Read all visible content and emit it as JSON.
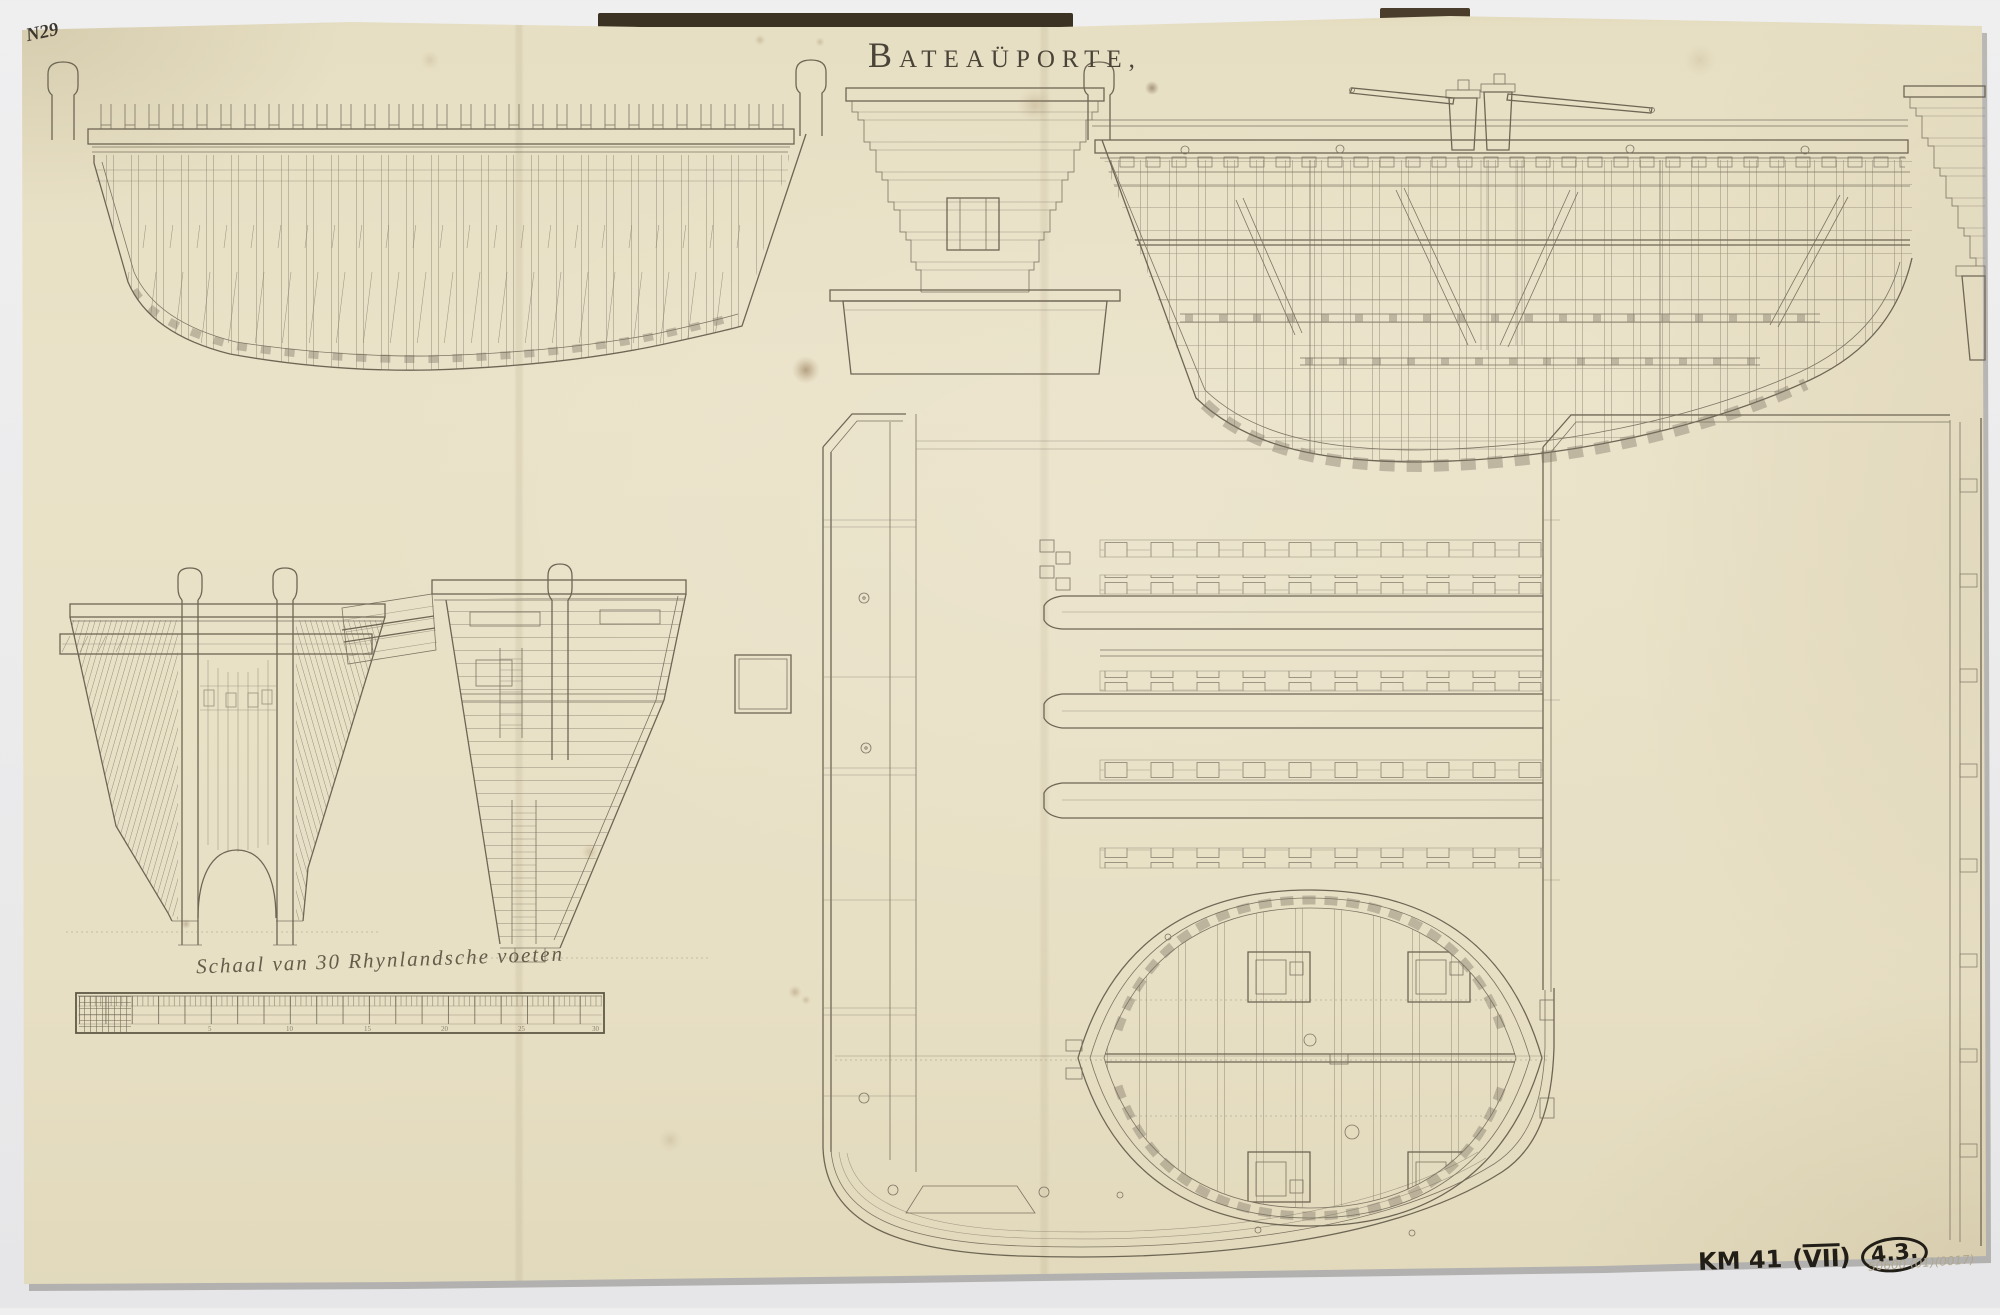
{
  "sheet": {
    "number": "N29",
    "title": {
      "initial": "B",
      "rest": "ATEAÜPORTE,"
    },
    "scale_label": "Schaal van 30 Rhynlandsche voeten",
    "ruler_numbers": [
      "5",
      "10",
      "15",
      "20",
      "25",
      "30"
    ],
    "stamps": {
      "inventory_code": "KM 41",
      "paren_l": "(",
      "volume_numeral": "VII",
      "paren_r": ")",
      "catalog_number": "4.3.",
      "pencil_note": "50600 (01)(0017)"
    }
  },
  "colors": {
    "background": "#ebebec",
    "paper": "#e7dfc3",
    "paper_edge_shade": "#d8cfae",
    "ink": "#7d7463",
    "ink_dark": "#55503f",
    "title_ink": "#4a4337",
    "stamp_ink": "#211d17",
    "pencil": "#b1a78d",
    "backing_strip": "#3c3223"
  }
}
